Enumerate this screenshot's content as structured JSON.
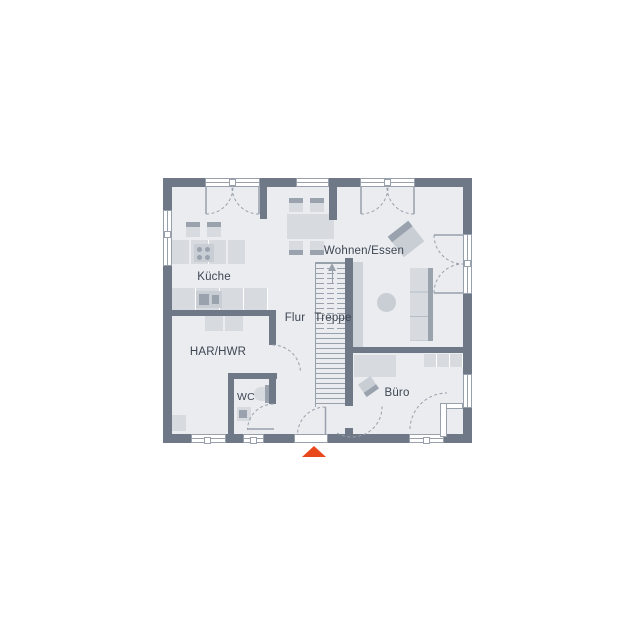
{
  "colors": {
    "wall": "#6e7887",
    "floor": "#eaecf0",
    "line": "#98a0ab",
    "text": "#3d4552",
    "accent": "#e8481c",
    "window": "#ffffff",
    "furn_light": "#d7dbe0",
    "furn_mid": "#c9ced5",
    "furn_dark": "#9aa2ae",
    "shaft": "#ced3da"
  },
  "rooms": {
    "kueche": {
      "label": "Küche"
    },
    "wohnen_essen": {
      "label": "Wohnen/Essen"
    },
    "flur": {
      "label": "Flur"
    },
    "treppe": {
      "label": "Treppe"
    },
    "har_hwr": {
      "label": "HAR/HWR"
    },
    "wc": {
      "label": "WC"
    },
    "buero": {
      "label": "Büro"
    }
  },
  "markers": {
    "entrance": {
      "shape": "triangle-up",
      "color": "#e8481c"
    }
  }
}
